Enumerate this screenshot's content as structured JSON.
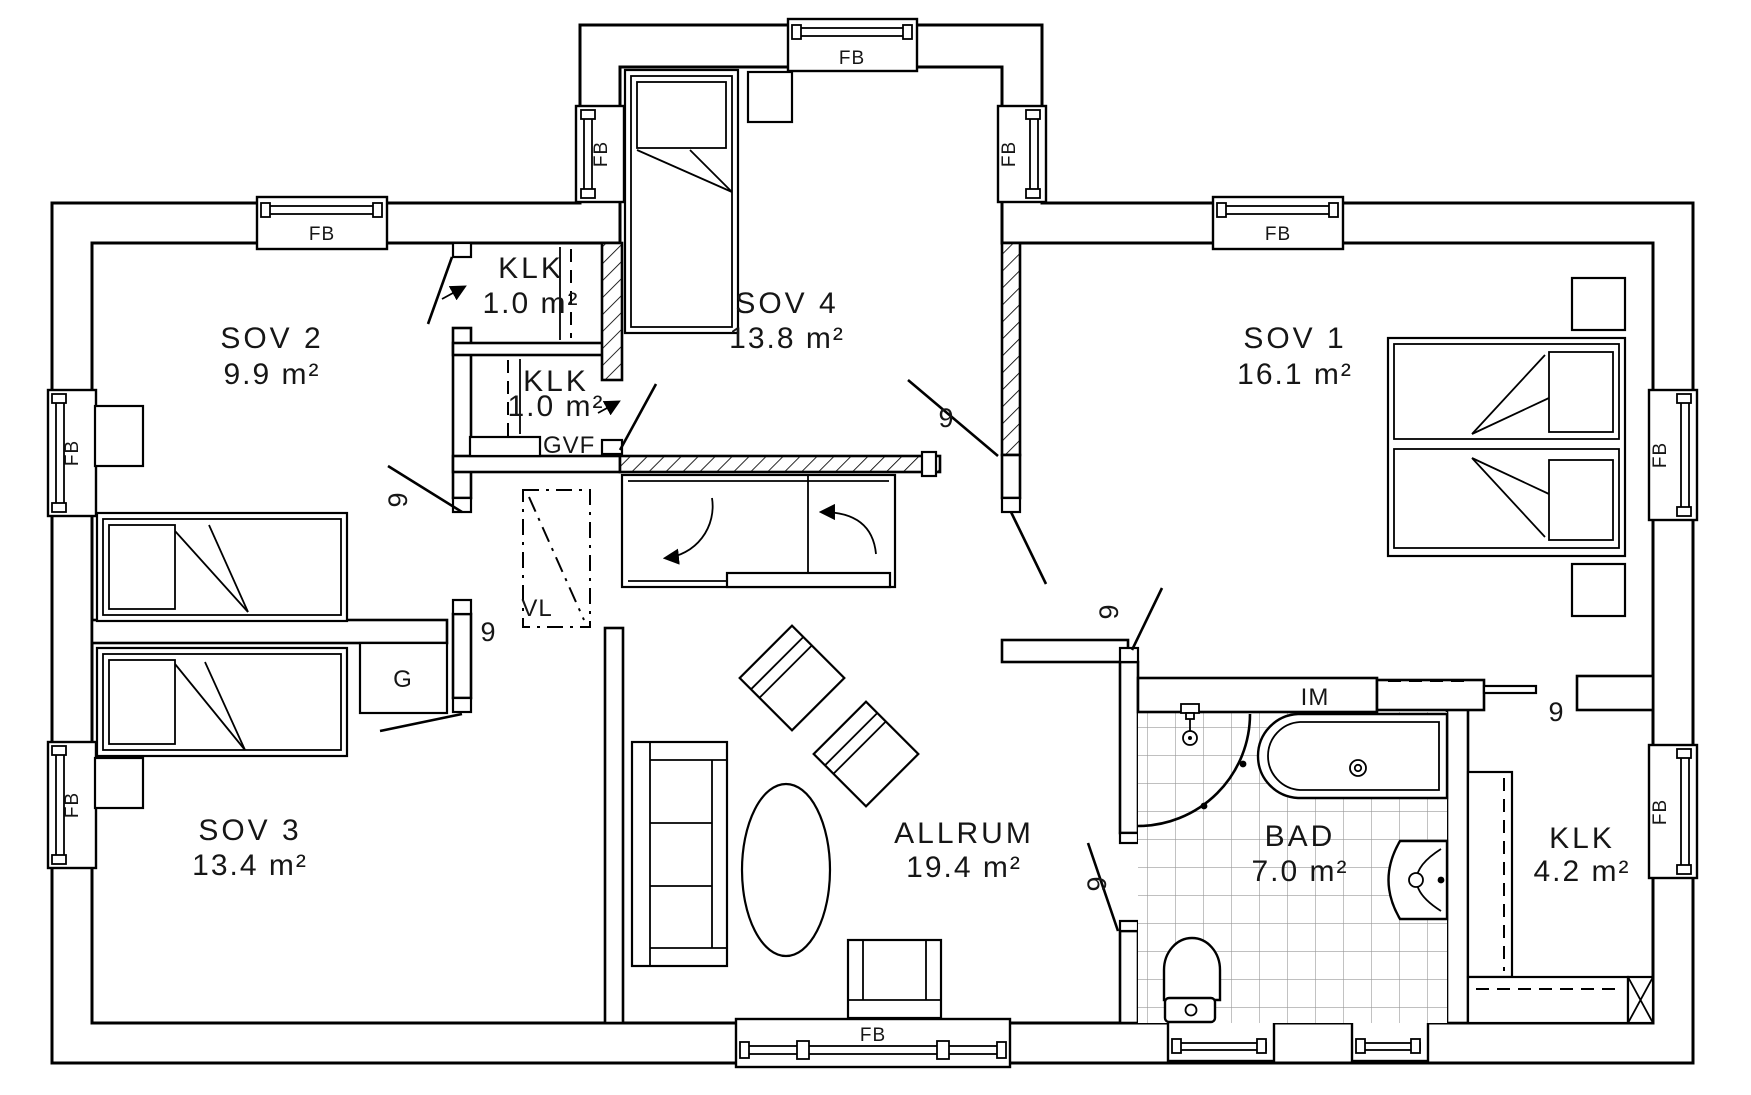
{
  "floor_plan": {
    "rooms": [
      {
        "name": "SOV 2",
        "area": "9.9 m²",
        "x": 272,
        "name_y": 348,
        "area_y": 384
      },
      {
        "name": "KLK",
        "area": "1.0 m²",
        "x": 531,
        "name_y": 278,
        "area_y": 313
      },
      {
        "name": "KLK",
        "area": "1.0 m²",
        "x": 556,
        "name_y": 391,
        "area_y": 416
      },
      {
        "name": "SOV 4",
        "area": "13.8 m²",
        "x": 787,
        "name_y": 313,
        "area_y": 348
      },
      {
        "name": "SOV 1",
        "area": "16.1 m²",
        "x": 1295,
        "name_y": 348,
        "area_y": 384
      },
      {
        "name": "SOV 3",
        "area": "13.4 m²",
        "x": 250,
        "name_y": 840,
        "area_y": 875
      },
      {
        "name": "ALLRUM",
        "area": "19.4 m²",
        "x": 964,
        "name_y": 843,
        "area_y": 877
      },
      {
        "name": "BAD",
        "area": "7.0 m²",
        "x": 1300,
        "name_y": 846,
        "area_y": 881
      },
      {
        "name": "KLK",
        "area": "4.2 m²",
        "x": 1582,
        "name_y": 848,
        "area_y": 881
      }
    ],
    "annotations": [
      {
        "text": "GVF",
        "x": 543,
        "y": 453,
        "rot": 0,
        "anchor": "start"
      },
      {
        "text": "VL",
        "x": 537,
        "y": 616,
        "rot": 0,
        "anchor": "middle"
      },
      {
        "text": "G",
        "x": 403,
        "y": 687,
        "rot": 0,
        "anchor": "middle"
      },
      {
        "text": "IM",
        "x": 1315,
        "y": 705,
        "rot": 0,
        "anchor": "middle"
      }
    ],
    "window_label": "FB",
    "window_labels": [
      {
        "x": 322,
        "y": 240,
        "rot": 0
      },
      {
        "x": 852,
        "y": 64,
        "rot": 0
      },
      {
        "x": 1278,
        "y": 240,
        "rot": 0
      },
      {
        "x": 873,
        "y": 1041,
        "rot": 0
      },
      {
        "x": 607,
        "y": 154,
        "rot": -90
      },
      {
        "x": 1015,
        "y": 154,
        "rot": -90
      },
      {
        "x": 78,
        "y": 453,
        "rot": -90
      },
      {
        "x": 78,
        "y": 805,
        "rot": -90
      },
      {
        "x": 1666,
        "y": 455,
        "rot": -90
      },
      {
        "x": 1666,
        "y": 812,
        "rot": -90
      }
    ],
    "door_size_label": "9",
    "door_labels": [
      {
        "x": 407,
        "y": 500,
        "rot": -90
      },
      {
        "x": 488,
        "y": 641,
        "rot": 0
      },
      {
        "x": 946,
        "y": 427,
        "rot": 0
      },
      {
        "x": 1118,
        "y": 612,
        "rot": -90
      },
      {
        "x": 1106,
        "y": 884,
        "rot": -90
      },
      {
        "x": 1556,
        "y": 721,
        "rot": 0
      }
    ]
  }
}
